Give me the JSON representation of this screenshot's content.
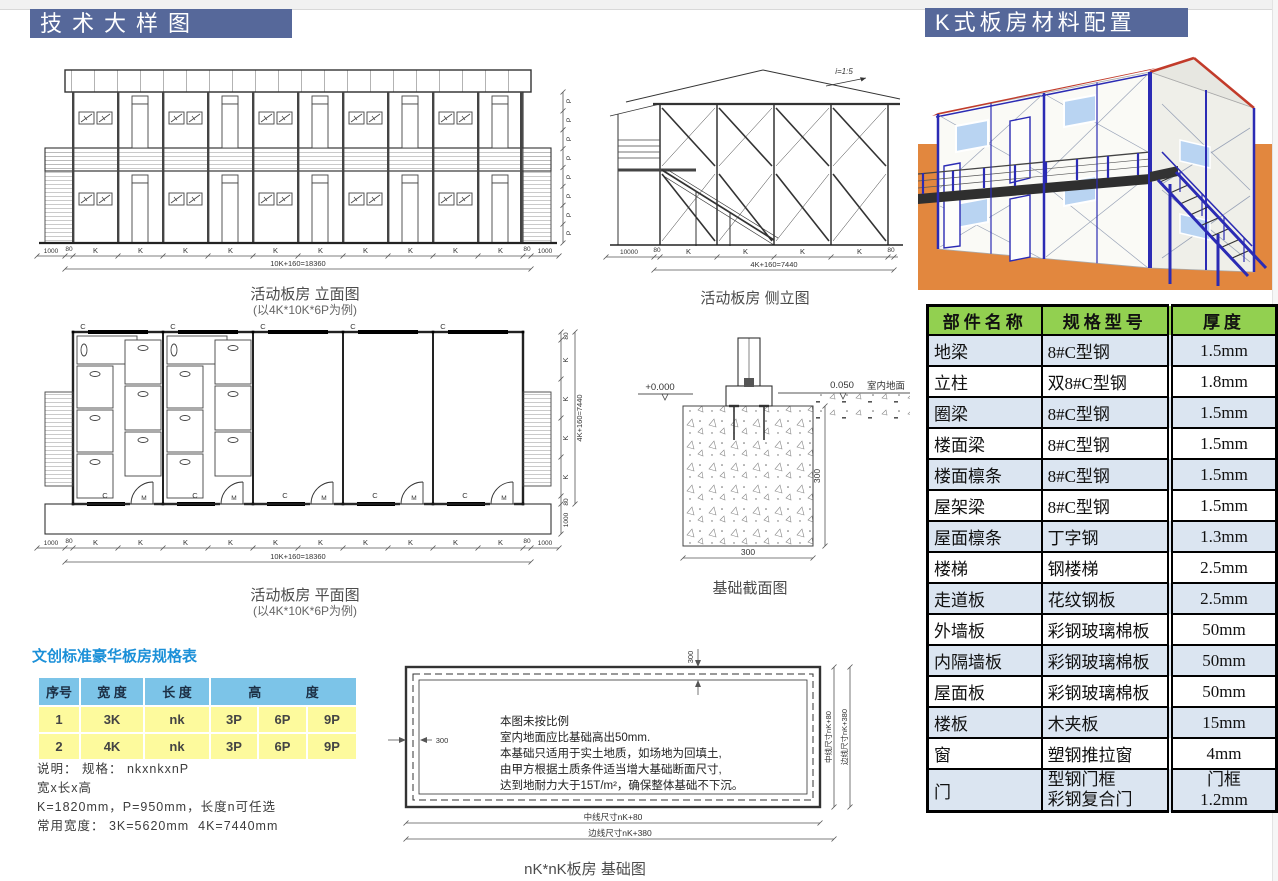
{
  "headers": {
    "left": "技术大样图",
    "right": "K式板房材料配置"
  },
  "captions": {
    "elevation_title": "活动板房 立面图",
    "elevation_sub": "(以4K*10K*6P为例)",
    "side_title": "活动板房 侧立图",
    "plan_title": "活动板房 平面图",
    "plan_sub": "(以4K*10K*6P为例)",
    "foundation_section_title": "基础截面图",
    "foundation_plan_title": "nK*nK板房 基础图"
  },
  "dims": {
    "k": "K",
    "p": "P",
    "c": "C",
    "m": "M",
    "d80": "80",
    "d1000": "1000",
    "d10000": "10000",
    "d300": "300",
    "total_long": "10K+160=18360",
    "total_short": "4K+160=7440",
    "slope": "i=1:5",
    "level_zero": "+0.000",
    "level_floor": "0.050",
    "indoor_ground": "室内地面",
    "mid_line": "中线尺寸nK+80",
    "edge_line": "边线尺寸nK+380"
  },
  "foundation_notes": [
    "本图未按比例",
    "室内地面应比基础高出50mm.",
    "本基础只适用于实土地质，如场地为回填土,",
    "由甲方根据土质条件适当增大基础断面尺寸,",
    "达到地耐力大于15T/m²，确保整体基础不下沉。"
  ],
  "spec_table": {
    "title": "文创标准豪华板房规格表",
    "col_no": "序号",
    "col_width": "宽 度",
    "col_length": "长 度",
    "col_height_1": "高",
    "col_height_2": "度",
    "rows": [
      [
        "1",
        "3K",
        "nk",
        "3P",
        "6P",
        "9P"
      ],
      [
        "2",
        "4K",
        "nk",
        "3P",
        "6P",
        "9P"
      ]
    ],
    "notes": [
      "说明： 规格： nkxnkxnP",
      "宽x长x高",
      "K=1820mm，P=950mm，长度n可任选",
      "常用宽度： 3K=5620mm  4K=7440mm"
    ]
  },
  "material_table": {
    "col_part": "部件名称",
    "col_spec": "规格型号",
    "col_thickness": "厚度",
    "rows": [
      {
        "part": "地梁",
        "spec": "8#C型钢",
        "thick": "1.5mm"
      },
      {
        "part": "立柱",
        "spec": "双8#C型钢",
        "thick": "1.8mm"
      },
      {
        "part": "圈梁",
        "spec": "8#C型钢",
        "thick": "1.5mm"
      },
      {
        "part": "楼面梁",
        "spec": "8#C型钢",
        "thick": "1.5mm"
      },
      {
        "part": "楼面檩条",
        "spec": "8#C型钢",
        "thick": "1.5mm"
      },
      {
        "part": "屋架梁",
        "spec": "8#C型钢",
        "thick": "1.5mm"
      },
      {
        "part": "屋面檩条",
        "spec": "丁字钢",
        "thick": "1.3mm"
      },
      {
        "part": "楼梯",
        "spec": "钢楼梯",
        "thick": "2.5mm"
      },
      {
        "part": "走道板",
        "spec": "花纹钢板",
        "thick": "2.5mm"
      },
      {
        "part": "外墙板",
        "spec": "彩钢玻璃棉板",
        "thick": "50mm"
      },
      {
        "part": "内隔墙板",
        "spec": "彩钢玻璃棉板",
        "thick": "50mm"
      },
      {
        "part": "屋面板",
        "spec": "彩钢玻璃棉板",
        "thick": "50mm"
      },
      {
        "part": "楼板",
        "spec": "木夹板",
        "thick": "15mm"
      },
      {
        "part": "窗",
        "spec": "塑钢推拉窗",
        "thick": "4mm"
      }
    ],
    "door_row": {
      "part": "门",
      "spec1": "型钢门框",
      "spec2": "彩钢复合门",
      "thick1": "门框",
      "thick2": "1.2mm"
    }
  }
}
